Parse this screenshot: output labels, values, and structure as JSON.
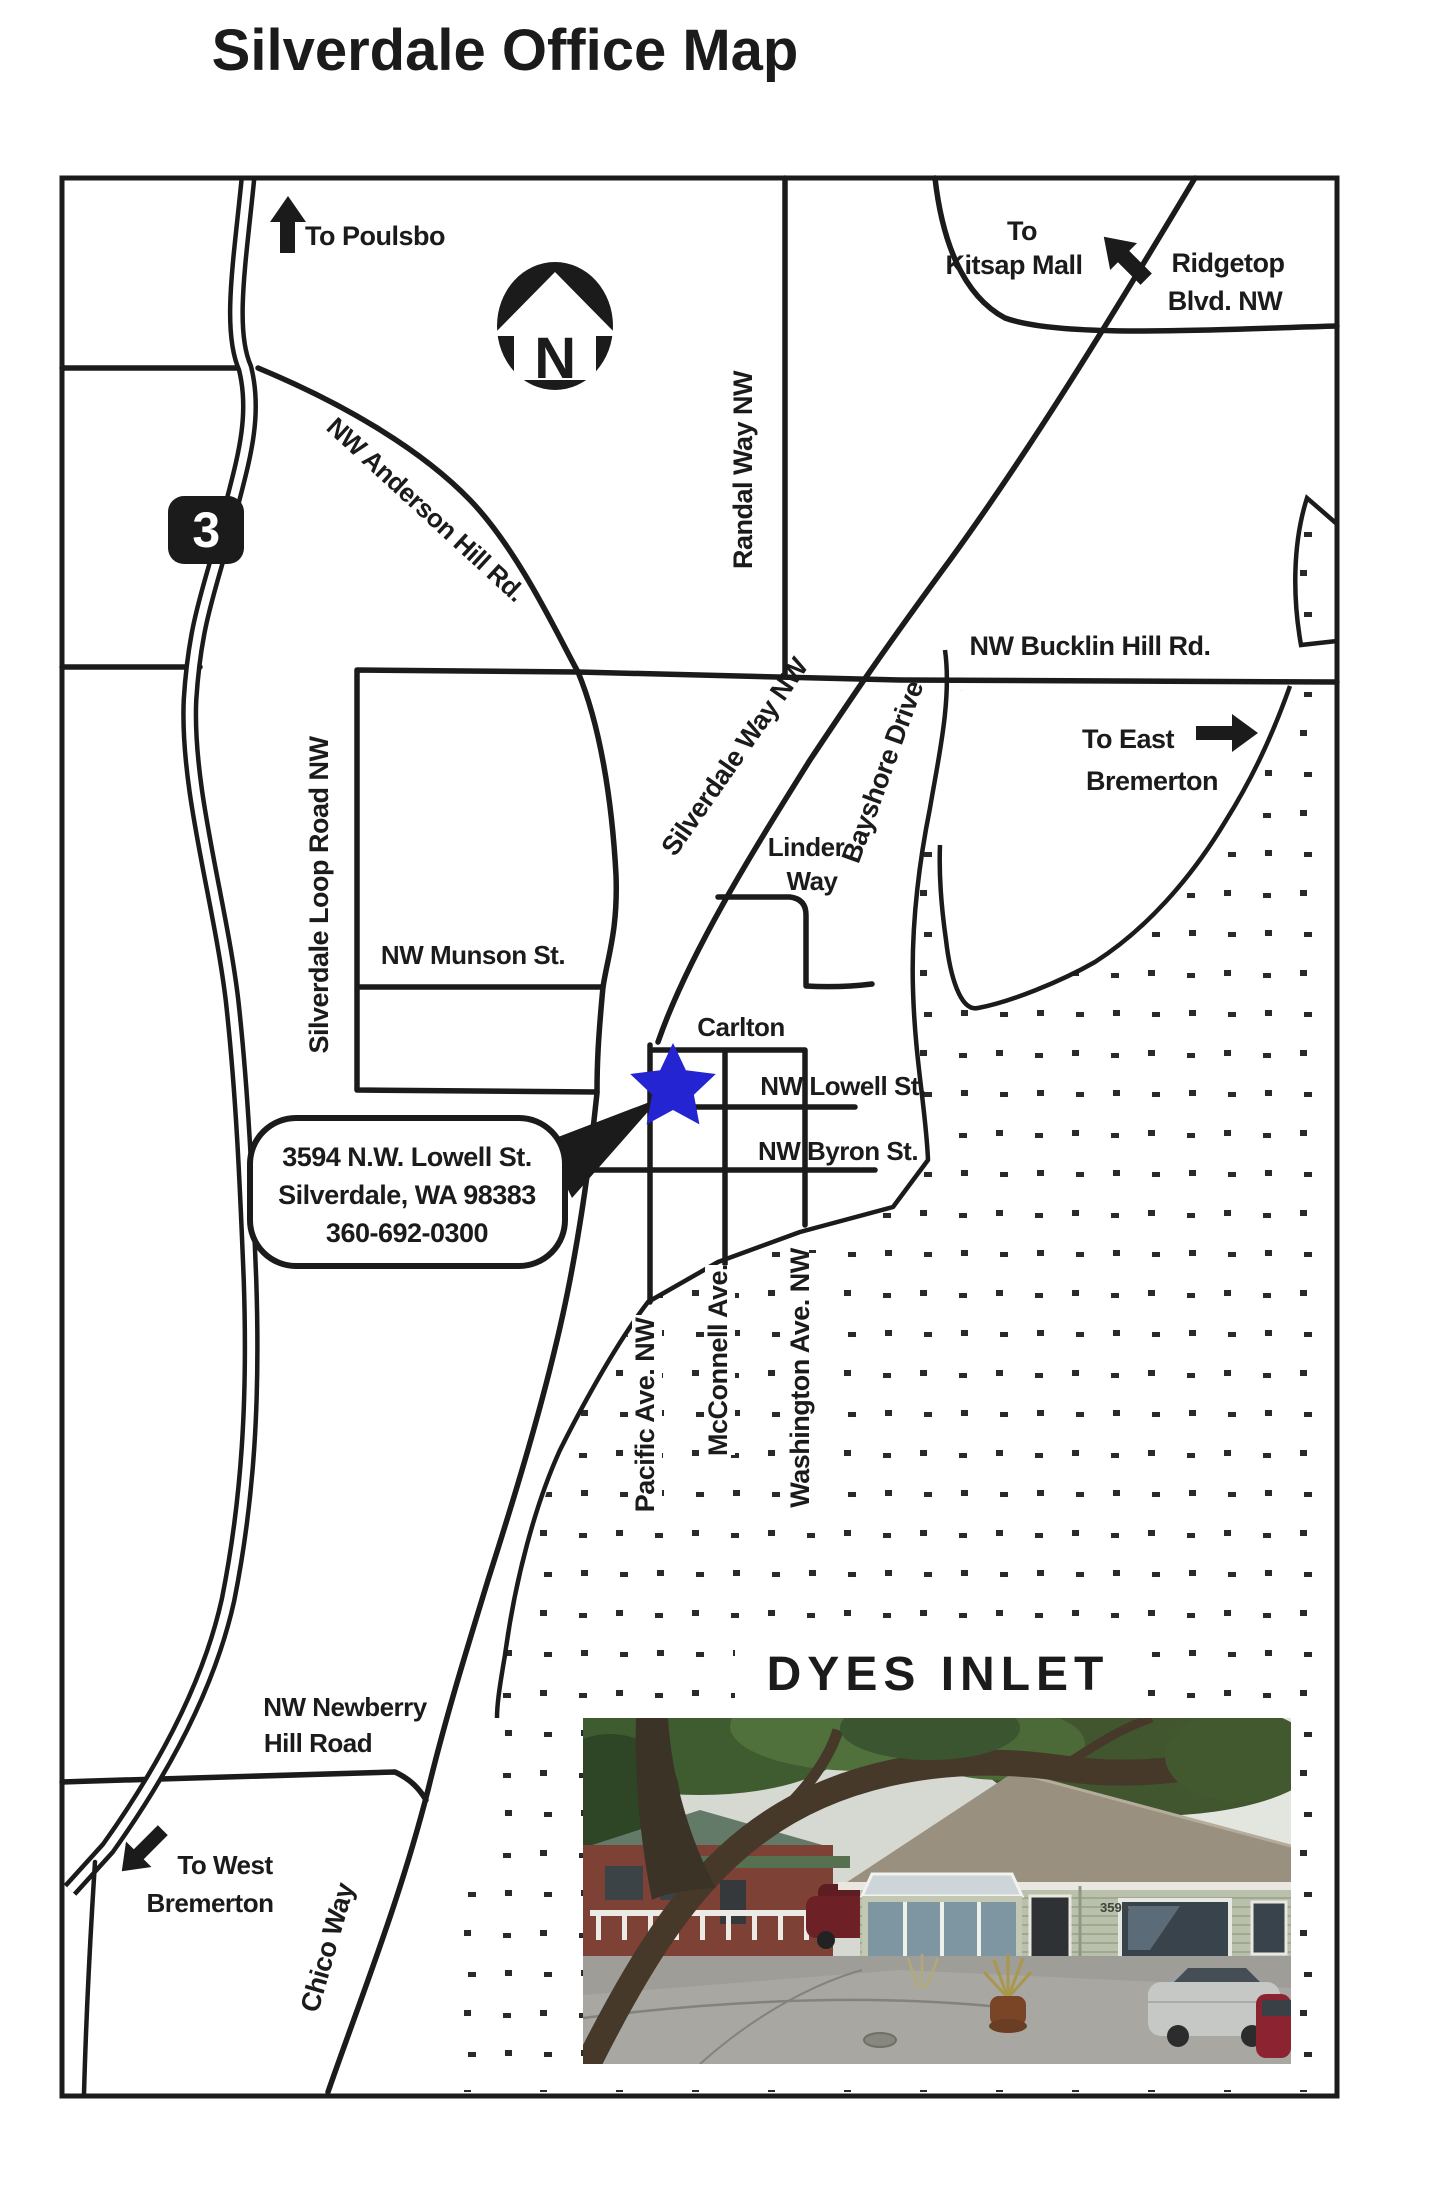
{
  "page": {
    "title": "Silverdale Office Map"
  },
  "colors": {
    "ink": "#1b1b1b",
    "star_blue": "#2424d2",
    "water_dot": "#2a2a2a"
  },
  "compass": {
    "letter": "N"
  },
  "highway_shield": {
    "number": "3"
  },
  "directions": {
    "poulsbo": "To Poulsbo",
    "kitsap_line1": "To",
    "kitsap_line2": "Kitsap Mall",
    "east_line1": "To East",
    "east_line2": "Bremerton",
    "west_line1": "To West",
    "west_line2": "Bremerton"
  },
  "streets": {
    "randal": "Randal Way NW",
    "ridgetop_line1": "Ridgetop",
    "ridgetop_line2": "Blvd. NW",
    "anderson": "NW Anderson Hill Rd.",
    "bucklin": "NW Bucklin Hill Rd.",
    "silverdale_way": "Silverdale Way NW",
    "bayshore": "Bayshore Drive",
    "linder_line1": "Linder",
    "linder_line2": "Way",
    "loop": "Silverdale Loop Road NW",
    "munson": "NW Munson St.",
    "carlton": "Carlton",
    "lowell": "NW Lowell St.",
    "byron": "NW Byron St.",
    "pacific": "Pacific Ave. NW",
    "mcconnell": "McConnell Ave.",
    "washington": "Washington Ave. NW",
    "newberry_line1": "NW Newberry",
    "newberry_line2": "Hill Road",
    "chico": "Chico Way"
  },
  "callout": {
    "line1": "3594 N.W. Lowell St.",
    "line2": "Silverdale, WA 98383",
    "line3": "360-692-0300"
  },
  "water": {
    "name": "DYES INLET"
  },
  "photo": {
    "building_number": "3594"
  }
}
